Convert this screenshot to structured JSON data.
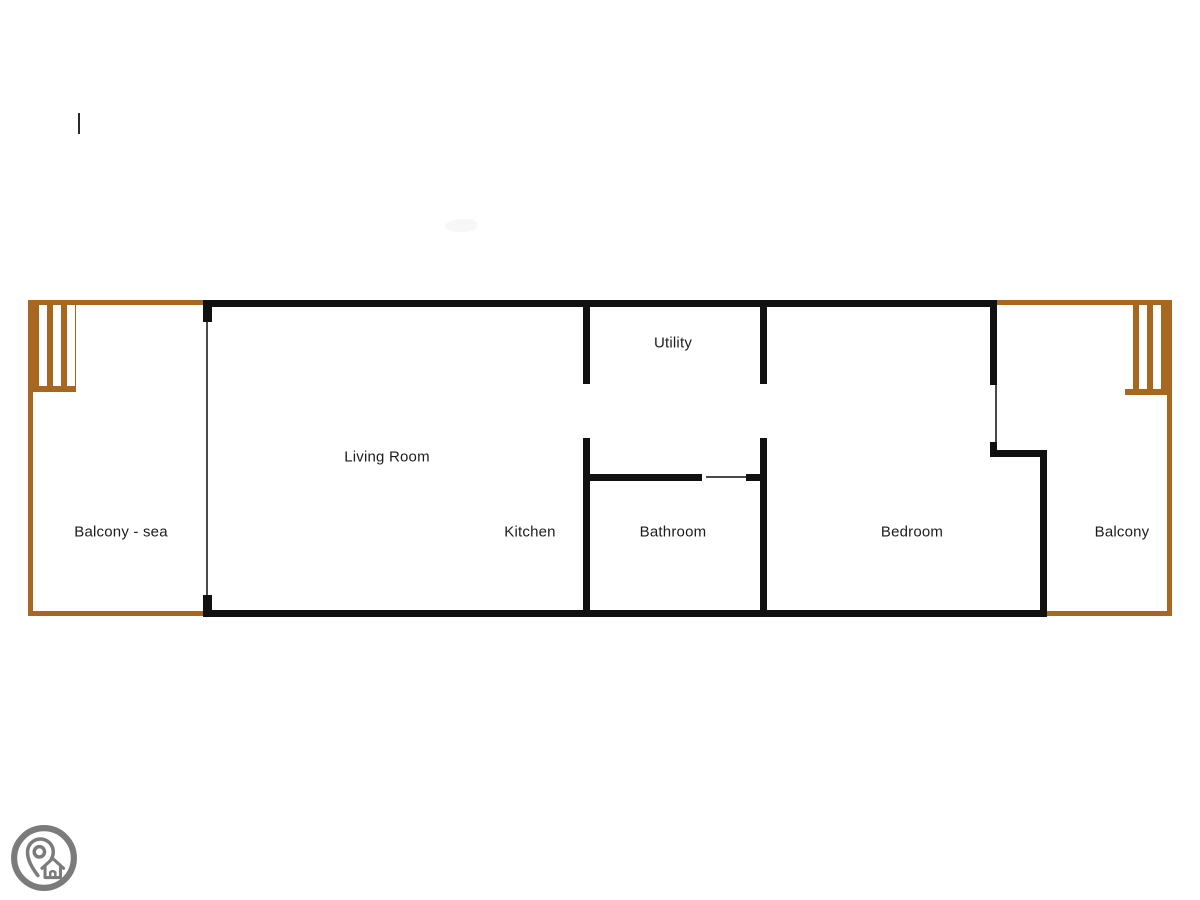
{
  "floor_plan": {
    "rooms": [
      {
        "id": "balcony-sea",
        "label": "Balcony - sea"
      },
      {
        "id": "living-room",
        "label": "Living Room"
      },
      {
        "id": "kitchen",
        "label": "Kitchen"
      },
      {
        "id": "utility",
        "label": "Utility"
      },
      {
        "id": "bathroom",
        "label": "Bathroom"
      },
      {
        "id": "bedroom",
        "label": "Bedroom"
      },
      {
        "id": "balcony",
        "label": "Balcony"
      }
    ],
    "colors": {
      "page_bg": "#ffffff",
      "wall": "#111111",
      "balcony_border": "#a8671f",
      "door_line": "#4a4a4a",
      "label_text": "#1c1c1c",
      "logo_gray": "#7b7b7b"
    }
  },
  "watermark": {
    "icon": "location-pin-house-logo"
  }
}
